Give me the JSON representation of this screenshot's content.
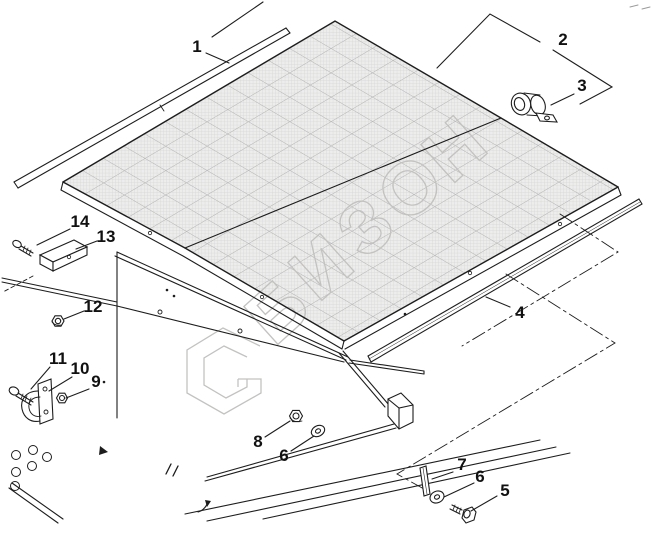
{
  "diagram": {
    "type": "exploded-parts-diagram",
    "callouts": [
      "1",
      "2",
      "3",
      "4",
      "5",
      "6",
      "7",
      "8",
      "9",
      "10",
      "11",
      "12",
      "13",
      "14"
    ],
    "parts_with_callouts": 14,
    "duplicate_callout": "6",
    "line_style": "black technical line art with dash-dot phantom outlines"
  },
  "watermark": {
    "text": "БИЗОН",
    "letters": [
      "Б",
      "И",
      "З",
      "О",
      "Н"
    ]
  },
  "colors": {
    "background": "#ffffff",
    "line": "#1d1d1d",
    "watermark": "#c3c2c1",
    "mesh_fill": "#ededec",
    "mesh_grid_fine": "#d6d6d6",
    "mesh_grid_coarse": "#b4b4b4"
  }
}
